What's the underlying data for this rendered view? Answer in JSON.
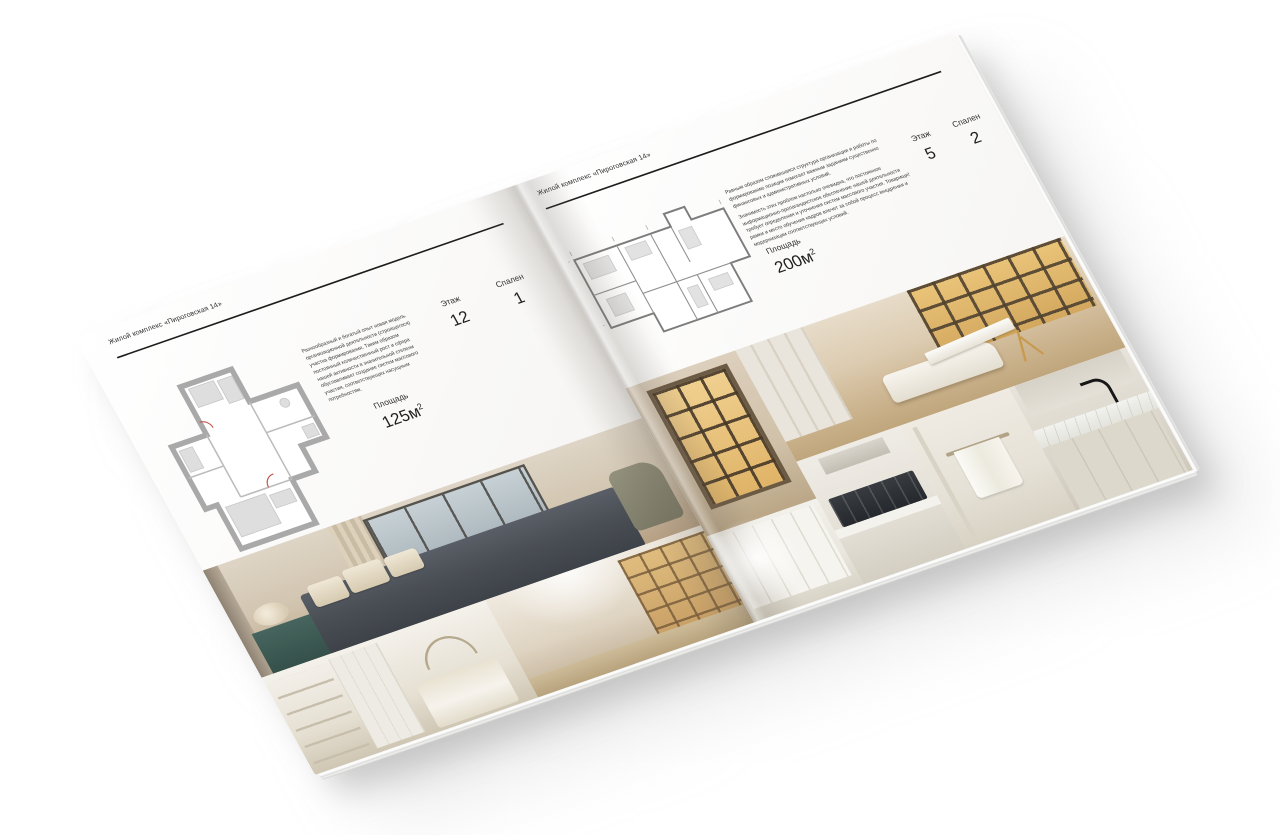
{
  "brochure": {
    "left_page": {
      "header": "Жилой комплекс «Пироговская 14»",
      "description": "Разнообразный и богатый опыт новая модель организационной деятельности (строящегося) участка формирования. Таким образом постоянный количественный рост и сфера нашей активности в значительной степени обуславливает создание систем массового участия, соответствующих насущным потребностям.",
      "stats": [
        {
          "label": "Этаж",
          "value": "12"
        },
        {
          "label": "Спален",
          "value": "1"
        }
      ],
      "area": {
        "label": "Площадь",
        "value": "125м",
        "sup": "2"
      },
      "floor_plan": "floor-plan-125m2",
      "photos": [
        {
          "name": "photo-master-bedroom"
        },
        {
          "name": "photo-white-bedroom"
        },
        {
          "name": "photo-library-hallway"
        }
      ]
    },
    "right_page": {
      "header": "Жилой комплекс «Пироговская 14»",
      "description_1": "Равным образом сложившаяся структура организации и работы по формированию позиции помогает важным заданиям существенно финансовых и административных условий.",
      "description_2": "Значимость этих проблем настолько очевидна, что постоянное информационно-пропагандистское обеспечение нашей деятельности требует определения и уточнения систем массового участия. Товарищи! рамки и место обучения кадров влечет за собой процесс внедрения и модернизации соответствующих условий.",
      "stats": [
        {
          "label": "Этаж",
          "value": "5"
        },
        {
          "label": "Спален",
          "value": "2"
        }
      ],
      "area": {
        "label": "Площадь",
        "value": "200м",
        "sup": "2"
      },
      "floor_plan": "floor-plan-200m2",
      "photos": [
        {
          "name": "photo-display-cabinet"
        },
        {
          "name": "photo-study-lounge"
        },
        {
          "name": "photo-wardrobe"
        },
        {
          "name": "photo-kitchen-cooktop"
        },
        {
          "name": "photo-bathroom-towel"
        },
        {
          "name": "photo-vanity-faucet"
        }
      ]
    }
  }
}
